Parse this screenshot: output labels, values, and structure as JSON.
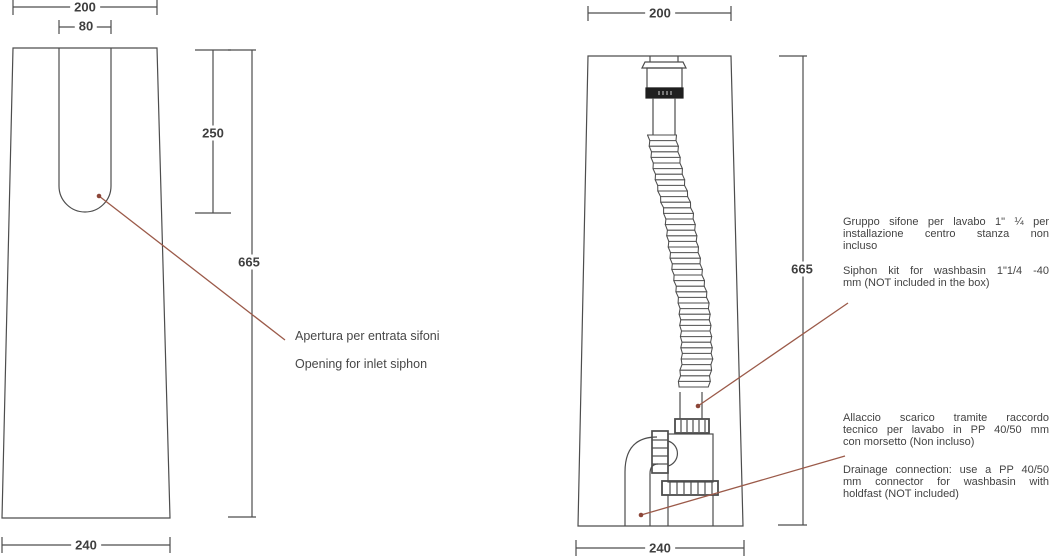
{
  "drawing": {
    "colors": {
      "line": "#4d4d4d",
      "dark_fitting": "#1f1f1f",
      "leader": "#9b5a49",
      "text": "#434343"
    },
    "left_view": {
      "dims": {
        "top_width": "200",
        "slot_width": "80",
        "slot_depth": "250",
        "height": "665",
        "bottom_width": "240"
      },
      "annotation": {
        "it": "Apertura per entrata sifoni",
        "en": "Opening for inlet siphon"
      }
    },
    "right_view": {
      "dims": {
        "top_width": "200",
        "height": "665",
        "bottom_width": "240"
      },
      "annotation_siphon": {
        "it_lines": [
          "Gruppo sifone per lavabo 1\" ¼ per",
          "installazione centro stanza non",
          "incluso"
        ],
        "en_lines": [
          "Siphon kit for washbasin 1\"1/4 -40",
          "mm (NOT included in the box)"
        ]
      },
      "annotation_drain": {
        "it_lines": [
          "Allaccio scarico tramite raccordo",
          "tecnico per lavabo in PP 40/50 mm",
          "con morsetto (Non incluso)"
        ],
        "en_lines": [
          "Drainage connection: use a PP 40/50",
          "mm connector for washbasin with",
          "holdfast (NOT included)"
        ]
      }
    }
  }
}
